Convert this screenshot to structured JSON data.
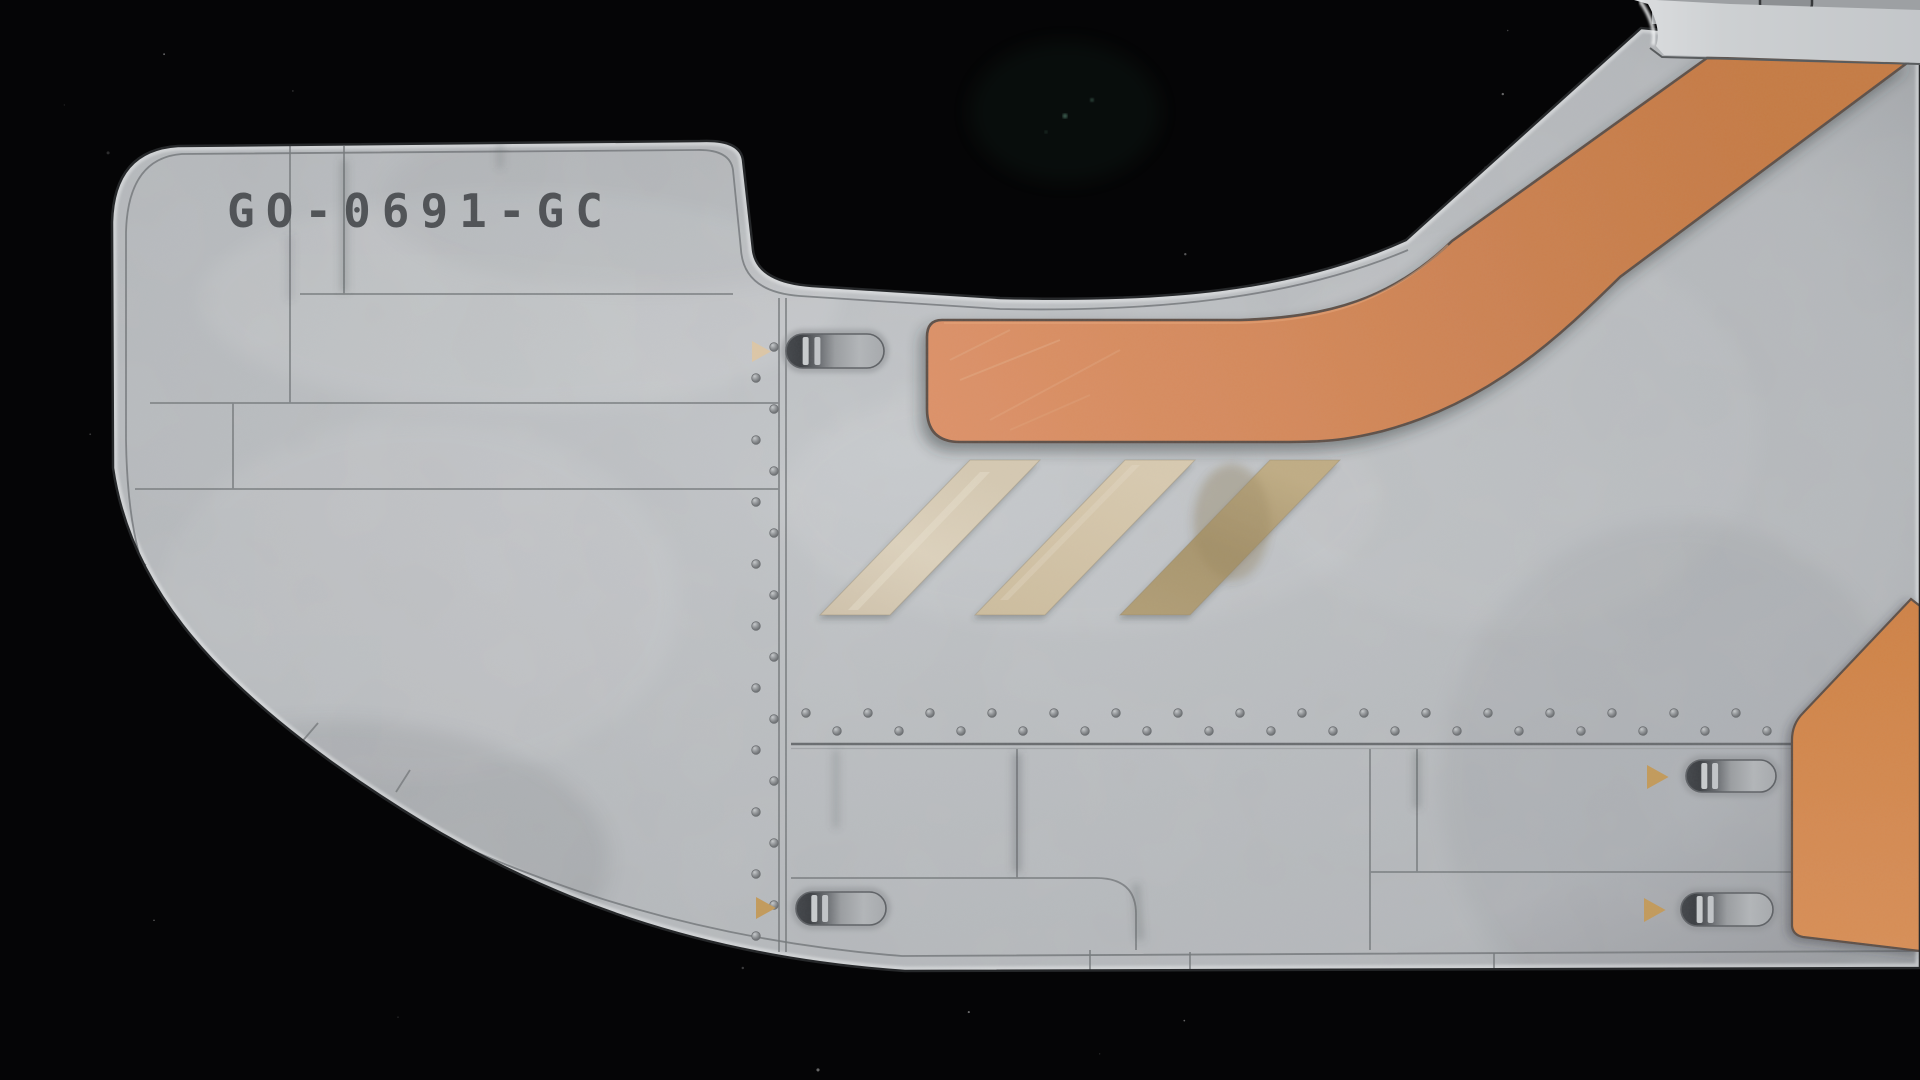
{
  "window": {
    "kind": "game-viewport"
  },
  "ship": {
    "registration": "GO-0691-GC"
  },
  "colors": {
    "space": "#050506",
    "hull": "#c2c5c8",
    "hull_light": "#d0d3d5",
    "hull_dark": "#a7aaae",
    "hull_edge": "#26282a",
    "seam": "#76797c",
    "orange_band": "#cd8450",
    "orange_band_light": "#dd9269",
    "orange_band_dark": "#c67b45",
    "orange_patch": "#d0854a",
    "outline_brown": "#5e5149",
    "stripe_1": "#d5c9b2",
    "stripe_2": "#d2c3a4",
    "stripe_3": "#b5a279",
    "marker_gold": "#c39b5c",
    "marker_pale": "#ddc7a7",
    "registration_text": "#46494d",
    "rivet": "#7e8184",
    "star": "#ffffff",
    "star_green": "#74b39a"
  },
  "decor": {
    "stars": {
      "count": 46,
      "seed": 20240711,
      "green": [
        [
          1065,
          116
        ],
        [
          1092,
          100
        ],
        [
          1046,
          132
        ]
      ]
    },
    "rivet_column": {
      "xa": 756,
      "xb": 774,
      "y0": 347,
      "y1": 944,
      "step": 31
    },
    "rivet_row_top": {
      "y": 713,
      "x0": 806,
      "x1": 1780,
      "step": 62
    },
    "rivet_row_bottom": {
      "y": 731,
      "x0": 837,
      "x1": 1780,
      "step": 62
    },
    "vents": [
      {
        "x": 786,
        "y": 334,
        "w": 98,
        "h": 34,
        "marker": {
          "x": 752,
          "y": 341,
          "size": 21,
          "pale": true
        }
      },
      {
        "x": 1686,
        "y": 760,
        "w": 90,
        "h": 32,
        "marker": {
          "x": 1647,
          "y": 765,
          "size": 24,
          "pale": false
        }
      },
      {
        "x": 1681,
        "y": 893,
        "w": 92,
        "h": 33,
        "marker": {
          "x": 1644,
          "y": 898,
          "size": 24,
          "pale": false
        }
      },
      {
        "x": 796,
        "y": 892,
        "w": 90,
        "h": 33,
        "marker": {
          "x": 756,
          "y": 897,
          "size": 22,
          "pale": false
        }
      }
    ]
  }
}
